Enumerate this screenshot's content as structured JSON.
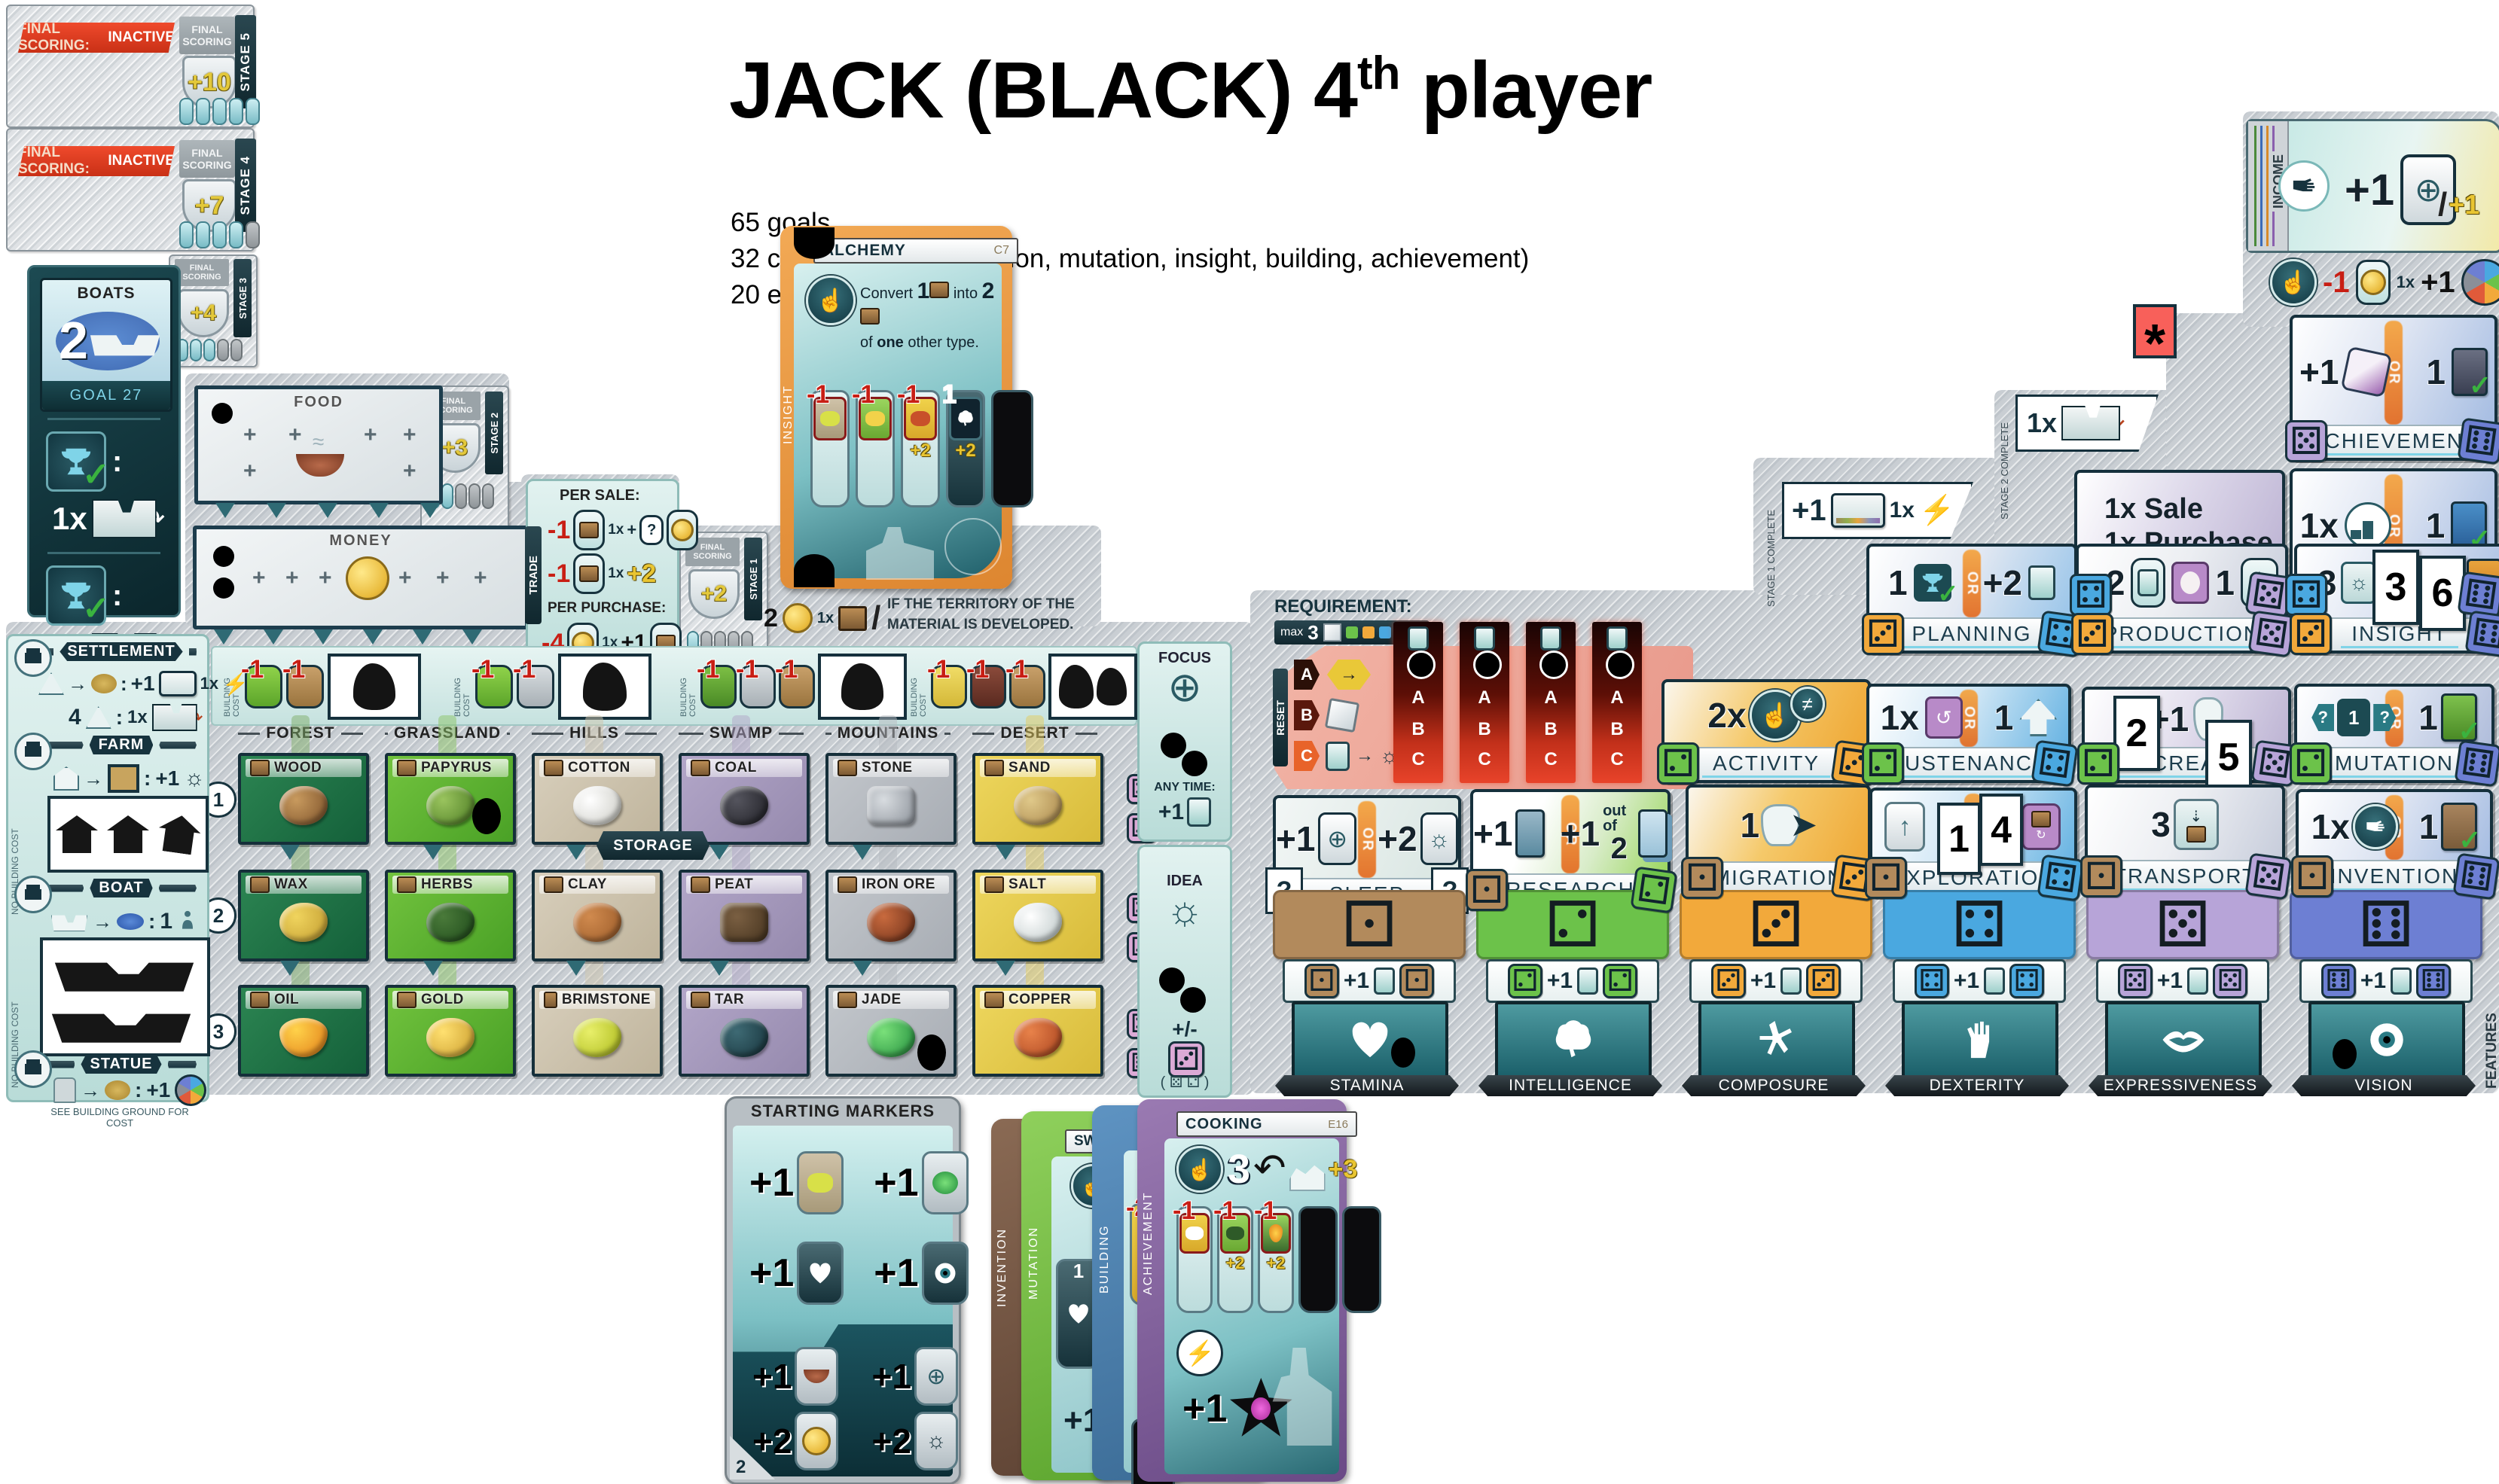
{
  "colors": {
    "player_black": "#000000",
    "red_banner": "#d83a20",
    "accent_orange": "#ee7f26",
    "teal_dark": "#1f6d75",
    "board_gray": "#c9ced3",
    "die_tan": "#b28a5c",
    "die_green": "#6cc24a",
    "die_orange": "#f2a93b",
    "die_blue": "#4aa8e0",
    "die_lavender": "#b7a4d8",
    "die_periwinkle": "#6d7fd3",
    "card_insight_orange": "#e8963f",
    "card_mutation_green": "#7ec14d",
    "card_building_blue": "#4a7fae",
    "card_achievement_purple": "#7b5d93",
    "card_invention_brown": "#7a5c49",
    "marker_red": "#f55a4e"
  },
  "hdr": {
    "t1": "JACK (BLACK) 4",
    "sup": "th",
    "t2": " player",
    "n0": "65 goals",
    "n1": "32 cards in deck (invention, mutation, insight, building, achievement)",
    "n2": "20 e"
  },
  "misc": {
    "colon": ":",
    "slash": "/"
  },
  "st": {
    "inactive_a": "Final scoring:",
    "inactive_b": "INACTIVE",
    "label": "Final scoring",
    "s5": "Stage 5",
    "p5": "+10",
    "s4": "Stage 4",
    "p4": "+7",
    "s3": "Stage 3",
    "p3": "+4",
    "s2": "Stage 2",
    "p2": "+3",
    "s1": "Stage 1",
    "p1": "+2"
  },
  "goal": {
    "title": "Boats",
    "value": "2",
    "footer": "Goal 27",
    "times": "1x"
  },
  "tracks": {
    "food": "Food",
    "money": "Money"
  },
  "trade": {
    "v": "Trade",
    "sale": "Per Sale:",
    "purchase": "Per Purchase:",
    "s1c": "-1",
    "s1t": "1x",
    "s1g": "+",
    "s1q": "?",
    "s2c": "-1",
    "s2t": "1x",
    "s2g": "+2",
    "pc": "-4",
    "pt": "1x",
    "pg": "+1",
    "alt_v": "2",
    "alt_t": "1x",
    "note": "If the territory of the material is developed."
  },
  "bc": {
    "label": "Building cost",
    "m": "-1"
  },
  "ter": [
    "Forest",
    "Grassland",
    "Hills",
    "Swamp",
    "Mountains",
    "Desert"
  ],
  "res": {
    "r1": [
      {
        "n": "Wood"
      },
      {
        "n": "Papyrus"
      },
      {
        "n": "Cotton"
      },
      {
        "n": "Coal"
      },
      {
        "n": "Stone"
      },
      {
        "n": "Sand"
      }
    ],
    "r2": [
      {
        "n": "Wax"
      },
      {
        "n": "Herbs"
      },
      {
        "n": "Clay"
      },
      {
        "n": "Peat"
      },
      {
        "n": "Iron Ore"
      },
      {
        "n": "Salt"
      }
    ],
    "r3": [
      {
        "n": "Oil"
      },
      {
        "n": "Gold"
      },
      {
        "n": "Brimstone"
      },
      {
        "n": "Tar"
      },
      {
        "n": "Jade"
      },
      {
        "n": "Copper"
      }
    ]
  },
  "rows": {
    "n1": "1",
    "n2": "2",
    "n3": "3"
  },
  "storage": "Storage",
  "side": {
    "settlement": "Settlement",
    "s_plus": "+1",
    "s_t": "1x",
    "s_4": "4",
    "s_t2": "1x",
    "farm": "Farm",
    "f_plus": "+1",
    "boat": "Boat",
    "b_v": "1",
    "statue": "Statue",
    "st_plus": "+1",
    "st_note": "See building ground for cost",
    "nbc": "No building cost"
  },
  "focus": {
    "title": "Focus",
    "any": "Any time:",
    "plus": "+1"
  },
  "idea": {
    "title": "Idea",
    "pm": "+/-",
    "swap": "( ⚄ ⚁ )"
  },
  "req": {
    "title": "Requirement:",
    "max": "max",
    "n": "3",
    "reset": "Reset",
    "a": "A",
    "b": "B",
    "c": "C"
  },
  "inc": {
    "label": "Income",
    "plus": "+1",
    "alt": "+1"
  },
  "inca": {
    "c": "-1",
    "t": "1x",
    "g": "+1"
  },
  "tabs": {
    "s2": "Stage 2 complete",
    "s2t": "1x",
    "s1": "Stage 1 complete",
    "s1p": "+1",
    "s1t": "1x"
  },
  "mark": "*",
  "act": {
    "trade": {
      "name": "Trade",
      "l1": "1x Sale",
      "l2": "1x Purchase",
      "dl": "⚃",
      "dr": "⚄"
    },
    "ach": {
      "name": "Achievement",
      "a": "+1",
      "or": "OR",
      "b": "1",
      "dl": "⚄",
      "dr": "⚅"
    },
    "bld": {
      "name": "Building",
      "a": "1x",
      "or": "OR",
      "b": "1",
      "dl": "⚃",
      "dr": "⚅"
    },
    "plan": {
      "name": "Planning",
      "a": "1",
      "or": "OR",
      "b": "+2",
      "dl": "⚂",
      "dr": "⚃"
    },
    "prod": {
      "name": "Production",
      "a": "+2",
      "b": "1",
      "dl": "⚂",
      "dr": "⚄"
    },
    "ins": {
      "name": "Insight",
      "a": "+3",
      "b3": "3",
      "b6": "6",
      "dl": "⚂",
      "dr": "⚅"
    },
    "acty": {
      "name": "Activity",
      "a": "2x",
      "dl": "⚁",
      "dr": "⚂"
    },
    "sus": {
      "name": "Sustenance",
      "a": "1x",
      "or": "OR",
      "b": "1",
      "dl": "⚁",
      "dr": "⚃"
    },
    "proc": {
      "name": "Procreation",
      "p": "+1",
      "b2": "2",
      "b5": "5",
      "dl": "⚁",
      "dr": "⚄"
    },
    "mut": {
      "name": "Mutation",
      "q": "?",
      "m": "1",
      "or": "OR",
      "b": "1",
      "dl": "⚁",
      "dr": "⚅"
    },
    "sleep": {
      "name": "Sleep",
      "a": "+1",
      "or": "OR",
      "b": "+2",
      "q": "?"
    },
    "res": {
      "name": "Research",
      "a": "+1",
      "or": "OR",
      "b": "+1",
      "oo": "out of",
      "n2": "2",
      "dl": "⚀",
      "dr": "⚁"
    },
    "mig": {
      "name": "Migration",
      "a": "1",
      "dl": "⚀",
      "dr": "⚂"
    },
    "exp": {
      "name": "Exploration",
      "b1": "1",
      "b4": "4",
      "dl": "⚀",
      "dr": "⚃"
    },
    "tra": {
      "name": "Transport",
      "a": "3",
      "dl": "⚀",
      "dr": "⚄"
    },
    "inv": {
      "name": "Invention",
      "a": "1x",
      "or": "OR",
      "b": "1",
      "dl": "⚀",
      "dr": "⚅"
    }
  },
  "attr": [
    {
      "n": "Stamina",
      "d": "⚀",
      "p": "+1"
    },
    {
      "n": "Intelligence",
      "d": "⚁",
      "p": "+1"
    },
    {
      "n": "Composure",
      "d": "⚂",
      "p": "+1"
    },
    {
      "n": "Dexterity",
      "d": "⚃",
      "p": "+1"
    },
    {
      "n": "Expressiveness",
      "d": "⚄",
      "p": "+1"
    },
    {
      "n": "Vision",
      "d": "⚅",
      "p": "+1"
    }
  ],
  "features": "Features",
  "alch": {
    "title": "Alchemy",
    "code": "C7",
    "tab": "Insight",
    "c1": "Convert",
    "n1": "1",
    "c2": "into",
    "n2": "2",
    "c3": "of",
    "c3b": "one",
    "c3c": "other type.",
    "v1": "-1",
    "v2": "-1",
    "v3": "-1",
    "v3b": "+2",
    "v4": "1",
    "v4b": "+2"
  },
  "cook": {
    "title": "Cooking",
    "code": "E16",
    "tab": "Achievement",
    "main": "3",
    "bonus": "+3",
    "v1": "-1",
    "v2": "-1",
    "v2b": "+2",
    "v3": "-1",
    "v3b": "+2",
    "star": "+1"
  },
  "fan": {
    "mut_tab": "Mutation",
    "mut_title": "Swe",
    "mut_v": "1",
    "bld_tab": "Building",
    "bld_v": "-2",
    "inv_tab": "Invention",
    "plus": "+1"
  },
  "startm": {
    "title": "Starting markers",
    "corner": "2",
    "i0": "+1",
    "i1": "+1",
    "i2": "+1",
    "i3": "+1",
    "i4": "+1",
    "i5": "+1",
    "i6": "+2",
    "i7": "+2"
  }
}
